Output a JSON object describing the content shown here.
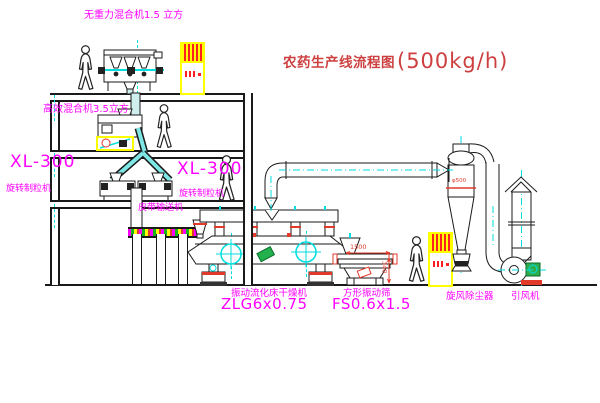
{
  "title": {
    "prefix": "农药生产线流程图",
    "capacity": "(500kg/h)"
  },
  "labels": {
    "top_mixer": "无重力混合机1.5 立方",
    "floor2_mixer": "高效混合机3.5立方",
    "left_granulator": {
      "model": "XL-300",
      "name": "旋转制粒机"
    },
    "center_granulator": {
      "model": "XL-300",
      "name": "旋转制粒机"
    },
    "belt_conveyor": "皮带输送机",
    "dryer": {
      "name": "振动流化床干燥机",
      "model": "ZLG6x0.75"
    },
    "sieve": {
      "name": "方形振动筛",
      "model": "FS0.6x1.5"
    },
    "cyclone": "旋风除尘器",
    "fan": "引风机"
  },
  "dimensions": {
    "sieve_length": "1500",
    "sieve_height": "340",
    "cyclone_marking": "φ500"
  },
  "colors": {
    "label_magenta": "#ff00ff",
    "title_red": "#cd4040",
    "accent_red": "#e23a2a",
    "equipment_yellow": "#ffff00",
    "centerline_cyan": "#00dede",
    "motor_green": "#2fae4e",
    "outline": "#1a1a1a"
  }
}
